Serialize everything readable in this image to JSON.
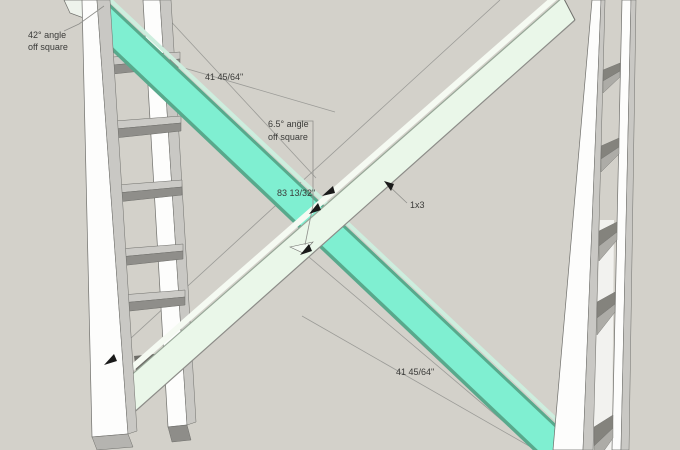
{
  "viewport": {
    "annotations": {
      "angle_top": {
        "line1": "42° angle",
        "line2": "off square"
      },
      "dim_top": "41 45/64\"",
      "angle_center": {
        "line1": "6.5° angle",
        "line2": "off square"
      },
      "dim_full": "83 13/32\"",
      "part_label": "1x3",
      "dim_bottom": "41 45/64\""
    },
    "colors": {
      "background": "#d3d1ca",
      "line": "#9b9b97",
      "leader": "#8f8f8b",
      "text": "#3b3b39",
      "arrow": "#1a1a1a",
      "teal_face": "#7fefd1",
      "teal_edge": "#58a98c",
      "teal_sliver": "#cdeede",
      "mint_face": "#eaf7e9",
      "mint_sliver": "#f5faf2",
      "mint_edge_top": "#97a697",
      "mint_edge_bottom": "#8c8c88",
      "rail_white": "#fdfdfc",
      "rail_side": "#c9c8c4",
      "rail_outline": "#6f6f6b",
      "shelf_top": "#cbcac6",
      "shelf_front": "#8f8e8a",
      "wedge_dark": "#84837d",
      "wedge_mid": "#adaca7",
      "wedge_shadow": "#6e6d68",
      "endcap_light": "#b5b4b0",
      "endcap_dark": "#8e8d89",
      "tip_face": "#eef3ec",
      "notch": "#f2faf2",
      "channel": "#f2f2ef"
    }
  }
}
